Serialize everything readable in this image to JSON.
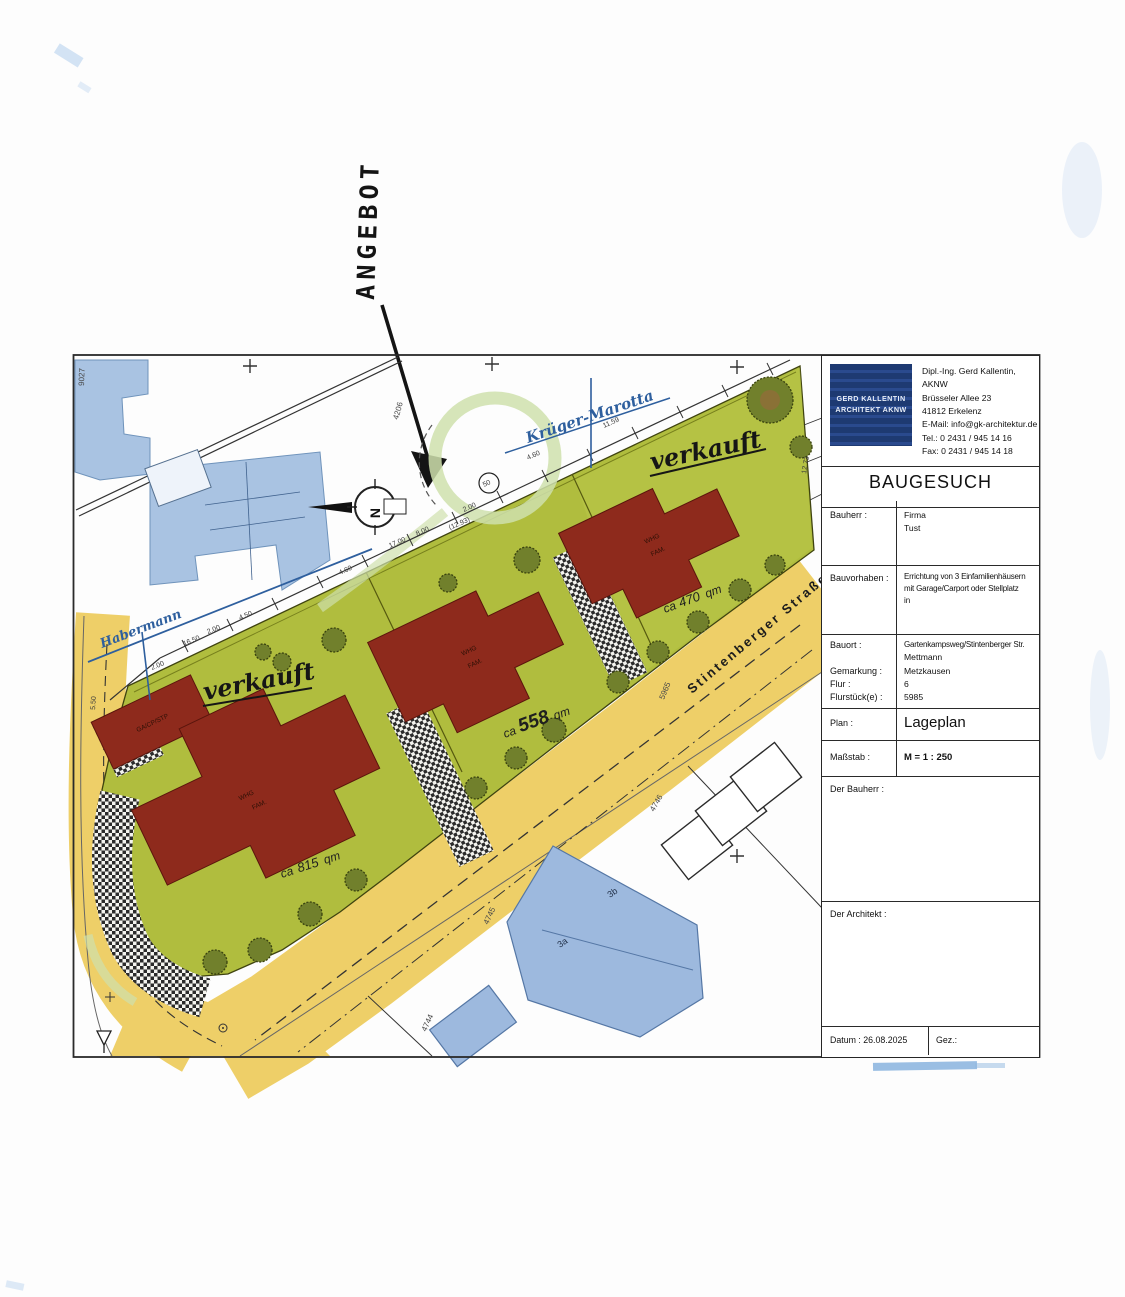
{
  "note": {
    "angebot": "ANGEBOT"
  },
  "map": {
    "street": "Stintenberger Straße",
    "sold_left": "verkauft",
    "sold_right": "verkauft",
    "hw_top": "Krüger-Marotta",
    "hw_left": "Habermann",
    "area_left": {
      "ca": "ca",
      "v": "815",
      "qm": "qm"
    },
    "area_mid": {
      "ca": "ca",
      "v": "558",
      "qm": "qm"
    },
    "area_right": {
      "ca": "ca",
      "v": "470",
      "qm": "qm"
    },
    "compass": "N",
    "circled": "50",
    "whg": "WHG",
    "fam": "FAM.",
    "garage": "GA/CP/STP",
    "b3a": "3a",
    "b3b": "3b",
    "parcels": [
      "9027",
      "4206",
      "5965",
      "4745",
      "4746",
      "4744"
    ],
    "dims": [
      "16.50",
      "2.00",
      "4.50",
      "2.00",
      "4.60",
      "17.00",
      "8.00",
      "(12.93)",
      "2.00",
      "4.60",
      "11.59",
      "12.73",
      "5.50"
    ]
  },
  "title_block": {
    "logo_line1": "GERD KALLENTIN",
    "logo_line2": "ARCHITEKT AKNW",
    "info": [
      "Dipl.-Ing. Gerd Kallentin, AKNW",
      "Brüsseler Allee 23",
      "41812 Erkelenz",
      "E-Mail: info@gk-architektur.de",
      "Tel.: 0 2431 / 945 14 16",
      "Fax: 0 2431 / 945 14 18"
    ],
    "doc_type": "BAUGESUCH",
    "bauherr_label": "Bauherr :",
    "bauherr_1": "Firma",
    "bauherr_2": "Tust",
    "bauvorhaben_label": "Bauvorhaben :",
    "bauvorhaben_1": "Errichtung von 3 Einfamilienhäusern",
    "bauvorhaben_2": "mit Garage/Carport oder Stellplatz",
    "bauvorhaben_3": "in",
    "bauort_label": "Bauort :",
    "bauort_1": "Gartenkampsweg/Stintenberger Str.",
    "bauort_2": "Mettmann",
    "gemarkung_label": "Gemarkung :",
    "gemarkung": "Metzkausen",
    "flur_label": "Flur :",
    "flur": "6",
    "flurstueck_label": "Flurstück(e) :",
    "flurstueck": "5985",
    "plan_label": "Plan :",
    "plan": "Lageplan",
    "massstab_label": "Maßstab :",
    "massstab": "M = 1 : 250",
    "sign_bauherr": "Der Bauherr :",
    "sign_architekt": "Der Architekt :",
    "datum": "Datum : 26.08.2025",
    "gez": "Gez.:"
  }
}
